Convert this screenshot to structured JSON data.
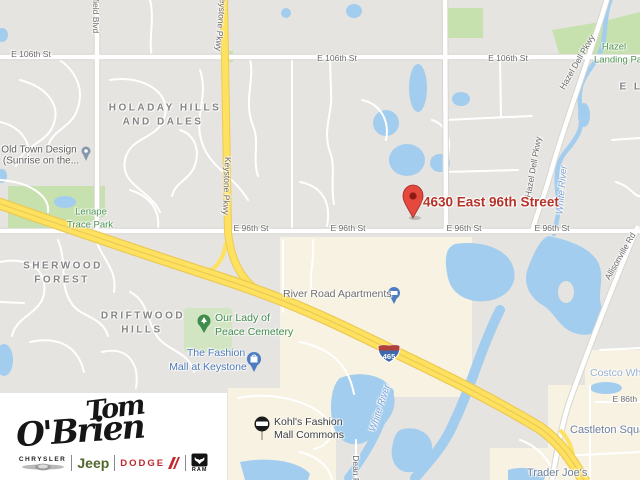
{
  "map": {
    "shield_number": "465",
    "colors": {
      "land": "#e6e4e0",
      "water": "#a3cdee",
      "park": "#c6e1ad",
      "cemetery": "#d2e5c3",
      "commercial": "#f7f2e1",
      "road": "#ffffff",
      "road_casing": "#d8d6d0",
      "highway_fill": "#fee15f",
      "highway_casing": "#ecca55",
      "marker_red": "#e5493d",
      "address_red": "#b73228"
    },
    "labels": [
      {
        "t": "E 106th St",
        "x": 31,
        "y": 54,
        "cls": "st",
        "name": "street-label-106th",
        "inter": "false"
      },
      {
        "t": "E 106th St",
        "x": 337,
        "y": 58,
        "cls": "st",
        "name": "street-label-106th",
        "inter": "false"
      },
      {
        "t": "E 106th St",
        "x": 508,
        "y": 58,
        "cls": "st",
        "name": "street-label-106th",
        "inter": "false"
      },
      {
        "t": "E 96th St",
        "x": 251,
        "y": 228,
        "cls": "st",
        "name": "street-label-96th",
        "inter": "false"
      },
      {
        "t": "E 96th St",
        "x": 348,
        "y": 228,
        "cls": "st",
        "name": "street-label-96th",
        "inter": "false"
      },
      {
        "t": "E 96th St",
        "x": 464,
        "y": 228,
        "cls": "st",
        "name": "street-label-96th",
        "inter": "false"
      },
      {
        "t": "E 96th St",
        "x": 552,
        "y": 228,
        "cls": "st",
        "name": "street-label-96th",
        "inter": "false"
      },
      {
        "t": "E 86th St",
        "x": 630,
        "y": 399,
        "cls": "st",
        "name": "street-label-86th",
        "inter": "false"
      },
      {
        "t": "field Blvd",
        "x": 96,
        "y": 16,
        "rot": 90,
        "cls": "st",
        "name": "street-label-field-blvd",
        "inter": "false"
      },
      {
        "t": "Keystone Pkwy",
        "x": 221,
        "y": 22,
        "rot": 95,
        "cls": "st",
        "name": "street-label-keystone-pkwy",
        "inter": "false"
      },
      {
        "t": "Keystone Pkwy",
        "x": 227,
        "y": 186,
        "rot": 92,
        "cls": "st",
        "name": "street-label-keystone-pkwy",
        "inter": "false"
      },
      {
        "t": "Hazel Dell Pkwy",
        "x": 577,
        "y": 62,
        "rot": -60,
        "cls": "st",
        "name": "street-label-hazel-dell",
        "inter": "false"
      },
      {
        "t": "Hazel Dell Pkwy",
        "x": 533,
        "y": 167,
        "rot": -80,
        "cls": "st",
        "name": "street-label-hazel-dell",
        "inter": "false"
      },
      {
        "t": "Allisonville Rd",
        "x": 620,
        "y": 256,
        "rot": -60,
        "cls": "st",
        "name": "street-label-allisonville",
        "inter": "false"
      },
      {
        "t": "Dean Rd",
        "x": 356,
        "y": 472,
        "rot": 90,
        "cls": "st",
        "name": "street-label-dean-rd",
        "inter": "false"
      },
      {
        "t": "White River",
        "x": 562,
        "y": 190,
        "rot": -85,
        "cls": "wt",
        "name": "water-label-white-river",
        "inter": "false"
      },
      {
        "t": "White River",
        "x": 380,
        "y": 408,
        "rot": -72,
        "cls": "wt",
        "name": "water-label-white-river",
        "inter": "false"
      },
      {
        "t": "HOLADAY HILLS",
        "x": 165,
        "y": 108,
        "cls": "nb",
        "name": "neighborhood-label-holaday",
        "inter": "false"
      },
      {
        "t": "AND DALES",
        "x": 163,
        "y": 122,
        "cls": "nb",
        "name": "neighborhood-label-holaday",
        "inter": "false"
      },
      {
        "t": "SHERWOOD",
        "x": 63,
        "y": 266,
        "cls": "nb",
        "name": "neighborhood-label-sherwood",
        "inter": "false"
      },
      {
        "t": "FOREST",
        "x": 62,
        "y": 280,
        "cls": "nb",
        "name": "neighborhood-label-sherwood",
        "inter": "false"
      },
      {
        "t": "DRIFTWOOD",
        "x": 143,
        "y": 316,
        "cls": "nb",
        "name": "neighborhood-label-driftwood",
        "inter": "false"
      },
      {
        "t": "HILLS",
        "x": 142,
        "y": 330,
        "cls": "nb",
        "name": "neighborhood-label-driftwood",
        "inter": "false"
      },
      {
        "t": "E L",
        "x": 631,
        "y": 87,
        "cls": "nb",
        "name": "neighborhood-label-partial",
        "inter": "false"
      },
      {
        "t": "Lenape",
        "x": 91,
        "y": 212,
        "cls": "pk",
        "name": "park-label-lenape",
        "inter": "true"
      },
      {
        "t": "Trace Park",
        "x": 90,
        "y": 225,
        "cls": "pk",
        "name": "park-label-lenape",
        "inter": "true"
      },
      {
        "t": "Hazel",
        "x": 614,
        "y": 47,
        "cls": "pk",
        "name": "park-label-hazel-landing",
        "inter": "true"
      },
      {
        "t": "Landing Park",
        "x": 622,
        "y": 60,
        "cls": "pk",
        "name": "park-label-hazel-landing",
        "inter": "true"
      },
      {
        "t": "Old Town Design",
        "x": 39,
        "y": 150,
        "cls": "pg",
        "name": "poi-label-old-town-design",
        "inter": "true"
      },
      {
        "t": "(Sunrise on the...",
        "x": 41,
        "y": 161,
        "cls": "pg",
        "name": "poi-label-old-town-design",
        "inter": "true"
      },
      {
        "t": "Our Lady of",
        "x": 215,
        "y": 318,
        "a": "l",
        "cls": "pgr",
        "name": "poi-label-cemetery",
        "inter": "true"
      },
      {
        "t": "Peace Cemetery",
        "x": 215,
        "y": 332,
        "a": "l",
        "cls": "pgr",
        "name": "poi-label-cemetery",
        "inter": "true"
      },
      {
        "t": "The Fashion",
        "x": 216,
        "y": 353,
        "cls": "pbl",
        "name": "poi-label-fashion-mall",
        "inter": "true"
      },
      {
        "t": "Mall at Keystone",
        "x": 208,
        "y": 367,
        "cls": "pbl",
        "name": "poi-label-fashion-mall",
        "inter": "true"
      },
      {
        "t": "River Road Apartments",
        "x": 283,
        "y": 294,
        "a": "l",
        "cls": "pg2",
        "name": "poi-label-river-road-apts",
        "inter": "true"
      },
      {
        "t": "Kohl's Fashion",
        "x": 274,
        "y": 422,
        "a": "l",
        "cls": "pdk",
        "name": "poi-label-kohls",
        "inter": "true"
      },
      {
        "t": "Mall Commons",
        "x": 274,
        "y": 435,
        "a": "l",
        "cls": "pdk",
        "name": "poi-label-kohls",
        "inter": "true"
      },
      {
        "t": "Castleton Squar",
        "x": 570,
        "y": 430,
        "a": "l",
        "cls": "psl",
        "name": "poi-label-castleton-square",
        "inter": "true"
      },
      {
        "t": "Trader Joe's",
        "x": 527,
        "y": 473,
        "a": "l",
        "cls": "psl",
        "name": "poi-label-trader-joes",
        "inter": "true"
      },
      {
        "t": "Costco Wh",
        "x": 590,
        "y": 373,
        "a": "l",
        "cls": "plb",
        "name": "poi-label-costco",
        "inter": "true"
      },
      {
        "t": "4630 East 96th Street",
        "x": 423,
        "y": 202,
        "a": "l",
        "cls": "mk",
        "name": "marker-address-label",
        "inter": "true"
      }
    ]
  },
  "logo": {
    "first_name": "Tom",
    "last_name": "O'Brien",
    "brands": {
      "chrysler": "CHRYSLER",
      "jeep": "Jeep",
      "dodge": "DODGE",
      "ram": "RAM"
    }
  }
}
